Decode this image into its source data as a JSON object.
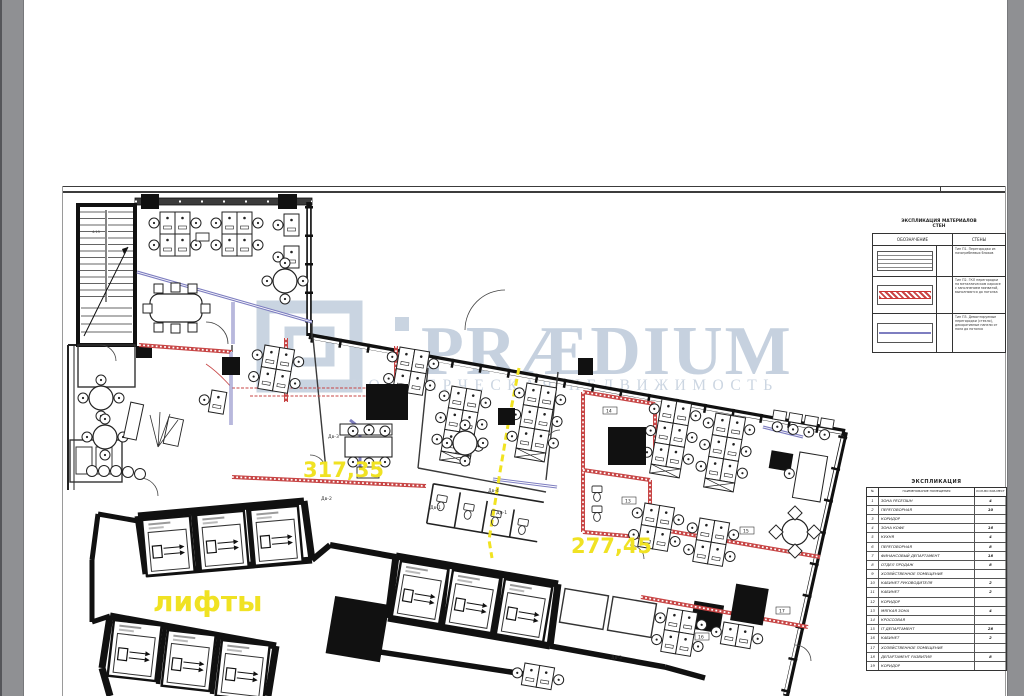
{
  "page": {
    "paper_color": "#ffffff",
    "margin_bar_color": "#8f9093"
  },
  "watermark": {
    "brand": "PRÆDIUM",
    "subtitle": "КОММЕРЧЕСКАЯ НЕДВИЖИМОСТЬ",
    "color": "#c7d2e0"
  },
  "plan": {
    "area_label_left": "317,35",
    "area_label_right": "277,45",
    "elevators_label": "лифты",
    "stair_label": "4.15",
    "door_labels": [
      "Дв-3",
      "Дв-2",
      "Дв-1",
      "Дн-1",
      "Дв-4",
      "Дв-3"
    ],
    "room_tags": [
      "14",
      "13",
      "15",
      "16",
      "17"
    ],
    "colors": {
      "wall": "#161616",
      "partition_red": "#c74545",
      "partition_blue": "#7e7ec0",
      "demising_yellow": "#f1e321",
      "label_yellow": "#f0e223"
    }
  },
  "materials_legend": {
    "title_line1": "ЭКСПЛИКАЦИЯ МАТЕРИАЛОВ",
    "title_line2": "СТЕН",
    "col_symbol": "ОБОЗНАЧЕНИЕ",
    "col_walls": "СТЕНЫ",
    "rows": [
      {
        "symbol": "plain",
        "text": "Тип П1. Перегородки из пазогребневых блоков"
      },
      {
        "symbol": "red-hatch",
        "text": "Тип П2. ГКЛ перегородки на металлическом каркасе с заполнением минватой, выполняются до потолка"
      },
      {
        "symbol": "blue-line",
        "text": "Тип П3. Демонтируемые перегородки (стекло), декоративные панели от пола до потолка"
      }
    ]
  },
  "explication": {
    "title": "ЭКСПЛИКАЦИЯ",
    "col_num": "№",
    "col_name": "НАИМЕНОВАНИЕ ПОМЕЩЕНИЯ",
    "col_seats": "КОЛ-ВО РАБ.МЕСТ",
    "rows": [
      [
        "1",
        "ЗОНА РЕСЕПШН",
        "4"
      ],
      [
        "2",
        "ПЕРЕГОВОРНАЯ",
        "10"
      ],
      [
        "3",
        "КОРИДОР",
        ""
      ],
      [
        "4",
        "ЗОНА КОФЕ",
        "16"
      ],
      [
        "5",
        "КУХНЯ",
        "4"
      ],
      [
        "6",
        "ПЕРЕГОВОРНАЯ",
        "8"
      ],
      [
        "7",
        "ФИНАНСОВЫЙ ДЕПАРТАМЕНТ",
        "18"
      ],
      [
        "8",
        "ОТДЕЛ ПРОДАЖ",
        "8"
      ],
      [
        "9",
        "ХОЗЯЙСТВЕННОЕ ПОМЕЩЕНИЕ",
        ""
      ],
      [
        "10",
        "КАБИНЕТ РУКОВОДИТЕЛЯ",
        "2"
      ],
      [
        "11",
        "КАБИНЕТ",
        "2"
      ],
      [
        "12",
        "КОРИДОР",
        ""
      ],
      [
        "13",
        "МЯГКАЯ ЗОНА",
        "4"
      ],
      [
        "14",
        "КРОССОВАЯ",
        ""
      ],
      [
        "15",
        "IT ДЕПАРТАМЕНТ",
        "28"
      ],
      [
        "16",
        "КАБИНЕТ",
        "2"
      ],
      [
        "17",
        "ХОЗЯЙСТВЕННОЕ ПОМЕЩЕНИЕ",
        ""
      ],
      [
        "18",
        "ДЕПАРТАМЕНТ РАЗВИТИЯ",
        "8"
      ],
      [
        "19",
        "КОРИДОР",
        ""
      ]
    ]
  }
}
